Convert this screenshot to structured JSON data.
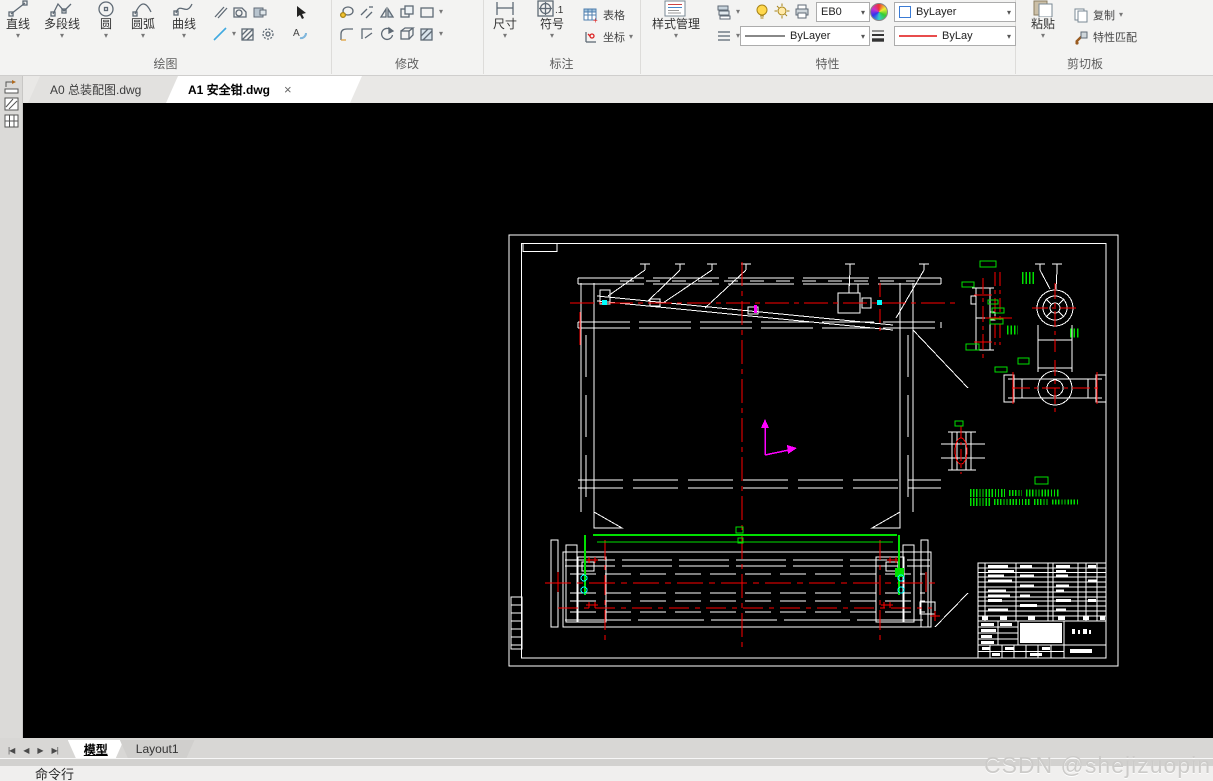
{
  "ribbon": {
    "draw": {
      "label": "绘图",
      "buttons": [
        "直线",
        "多段线",
        "圆",
        "圆弧",
        "曲线"
      ]
    },
    "modify": {
      "label": "修改"
    },
    "annotate": {
      "label": "标注",
      "dim": "尺寸",
      "symbol": "符号",
      "table": "表格",
      "coord": "坐标"
    },
    "properties": {
      "label": "特性",
      "style_manager": "样式管理",
      "layer_value": "EB0",
      "color_value": "ByLayer",
      "linetype_value": "ByLayer",
      "lineweight_value": "ByLay"
    },
    "clipboard": {
      "label": "剪切板",
      "paste": "粘贴",
      "copy": "复制",
      "match_props": "特性匹配"
    }
  },
  "doc_tabs": {
    "tab1": "A0 总装配图.dwg",
    "tab2": "A1 安全钳.dwg",
    "close": "×"
  },
  "bottom": {
    "nav_first": "|◀",
    "nav_prev": "◀",
    "nav_next": "▶",
    "nav_last": "▶|",
    "model_tab": "模型",
    "layout_tab": "Layout1",
    "command_label": "命令行"
  },
  "watermark": "CSDN @shejizuopin",
  "dropdown_glyph": "▾",
  "colors": {
    "canvas_bg": "#000000",
    "geometry": "#ffffff",
    "centerlines": "#ff0000",
    "annotations": "#00ff00",
    "markers": "#00ffff",
    "ucs_icon": "#ff00ff",
    "ribbon_bg": "#f3f3f2",
    "active_tab_bg": "#ffffff"
  }
}
